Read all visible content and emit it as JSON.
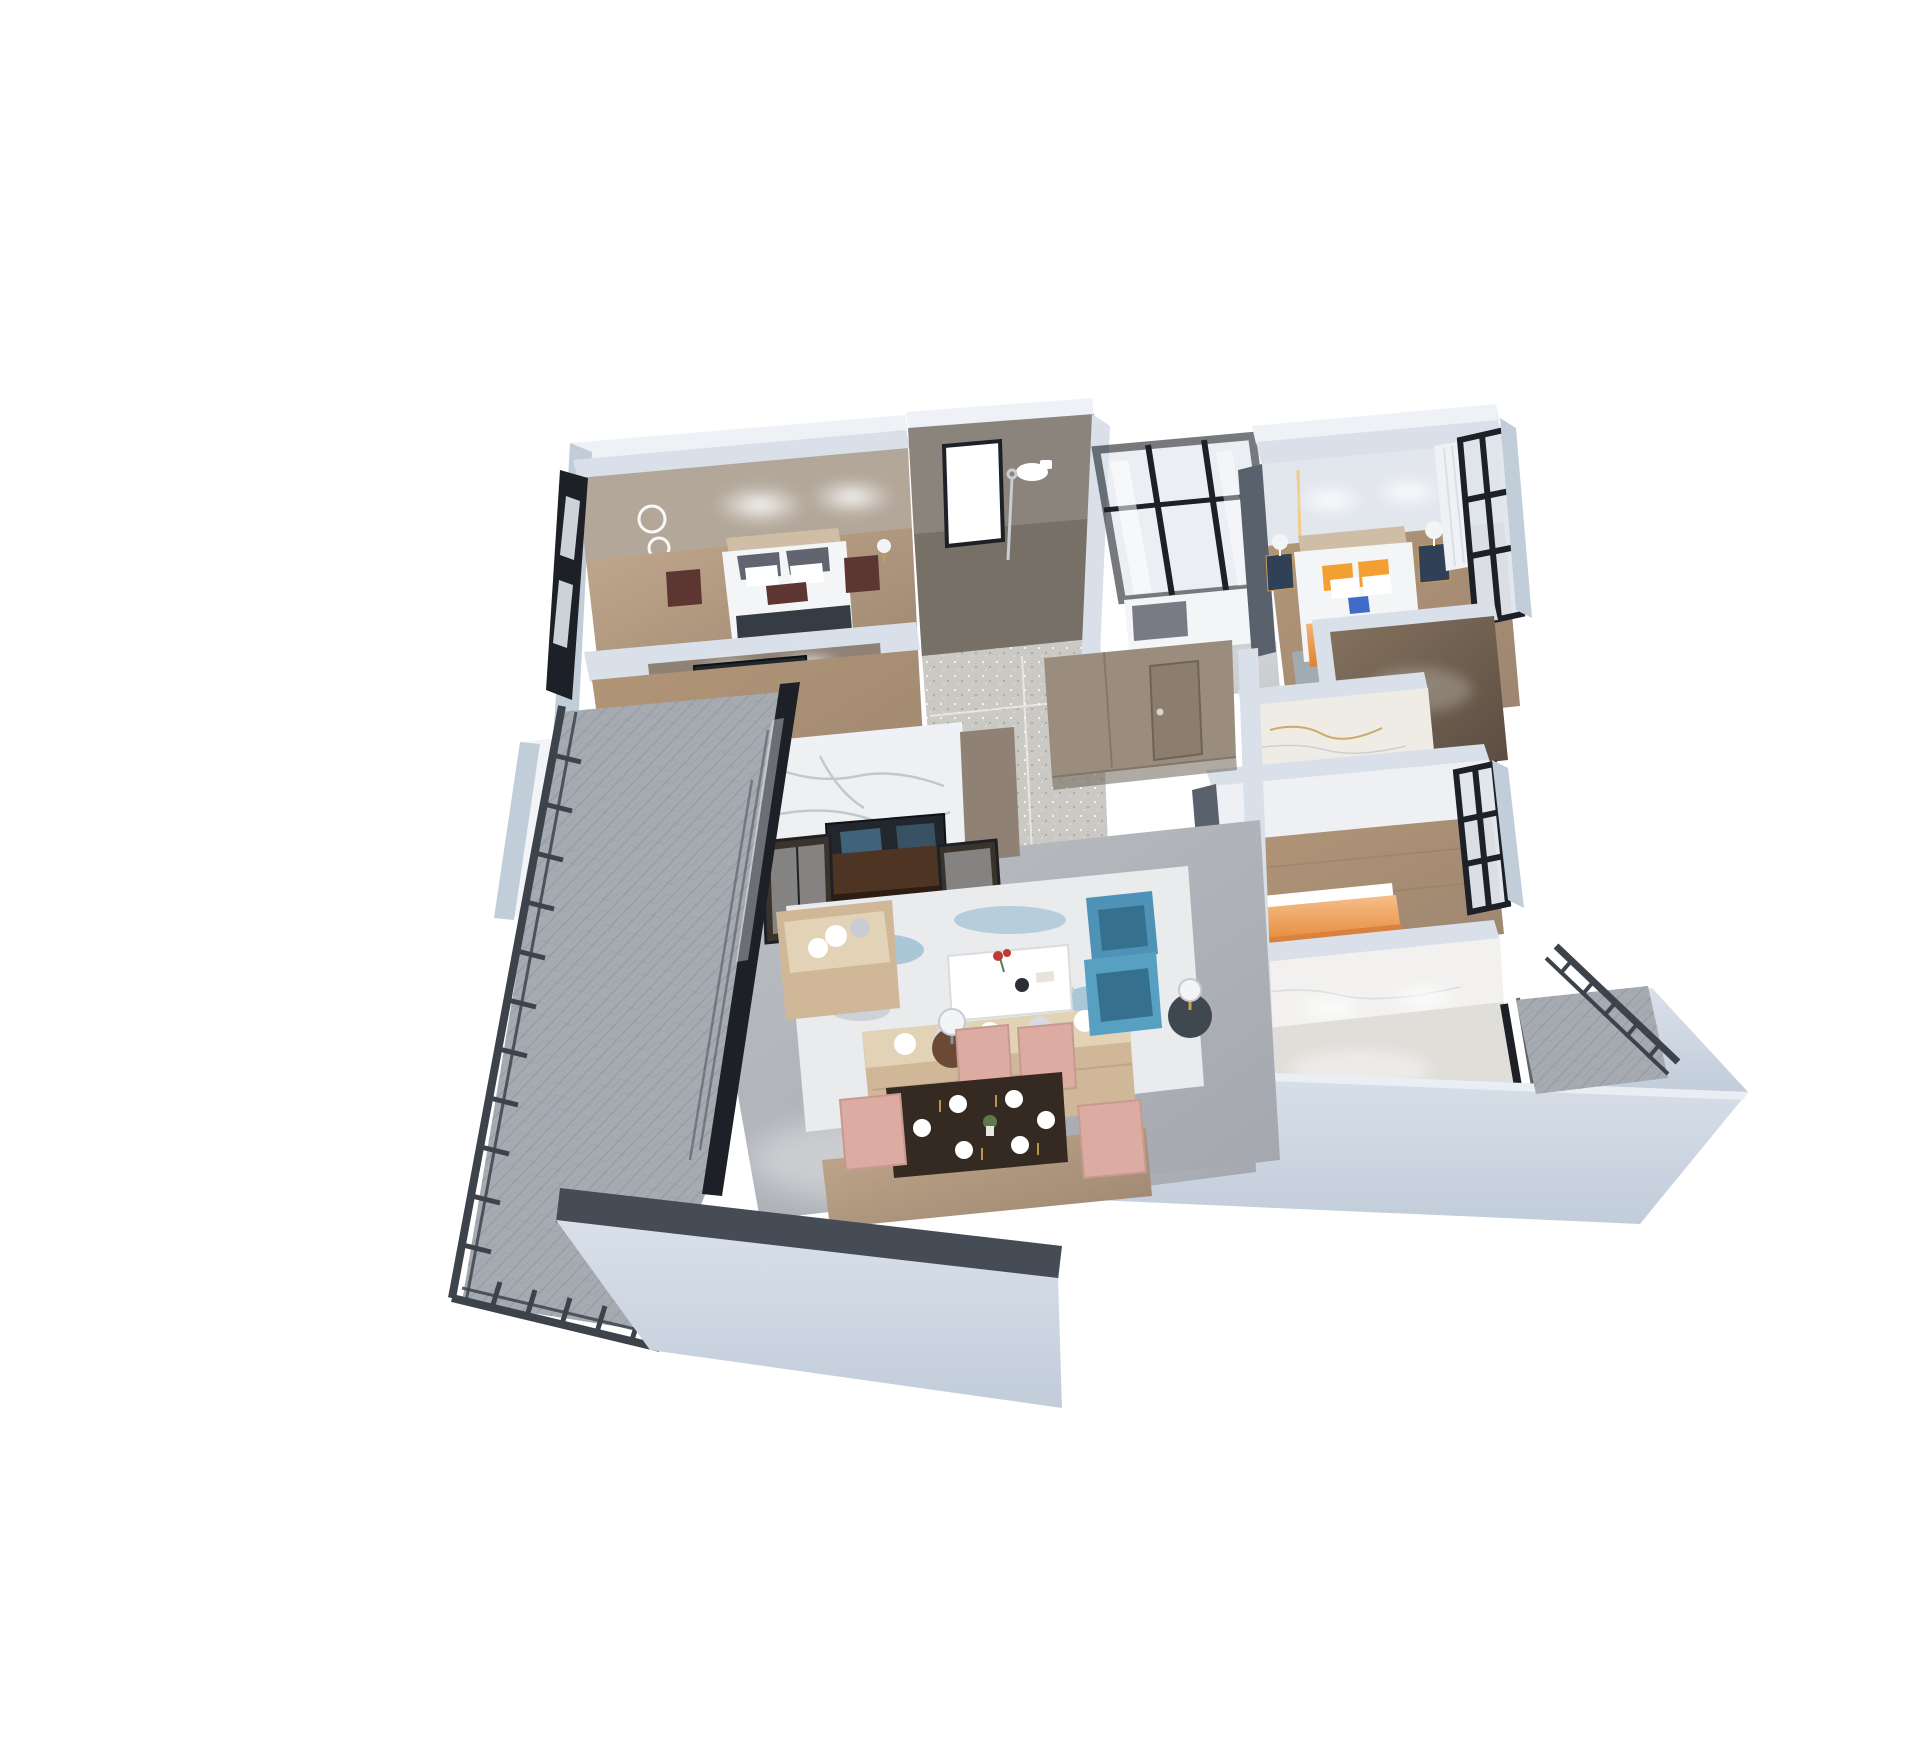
{
  "canvas": {
    "width": 1920,
    "height": 1754,
    "background": "#ffffff",
    "description": "Photorealistic 3D dollhouse-style isometric render of a furnished apartment floor plan on a white background"
  },
  "scene": {
    "rooms": [
      {
        "id": "bedroom-top-left",
        "label": "Bedroom 1",
        "furniture": [
          "double bed with dark gray pillows",
          "beige headboard",
          "two dark walnut nightstands",
          "ring pendant wall light",
          "left window wall",
          "ceiling spotlights"
        ]
      },
      {
        "id": "tv-room",
        "label": "Bedroom 1 TV wall / second room",
        "furniture": [
          "wall-mounted TV",
          "wood floor",
          "left window"
        ]
      },
      {
        "id": "bathroom-main",
        "label": "Main bathroom",
        "furniture": [
          "white glass shower door",
          "toilet",
          "shower column",
          "taupe stone tile walls",
          "speckled tile floor"
        ]
      },
      {
        "id": "glass-study",
        "label": "Glass-walled small bedroom",
        "furniture": [
          "black framed glass partition",
          "bed with patterned pillow",
          "blue stool"
        ]
      },
      {
        "id": "master-bedroom",
        "label": "Master bedroom",
        "furniture": [
          "bed with orange pillows and orange runner",
          "navy nightstands with white drum lamps",
          "charcoal wardrobe",
          "black framed window wall",
          "white curtain",
          "blue rug",
          "warm LED wall strips"
        ]
      },
      {
        "id": "ensuite",
        "label": "Ensuite / walk-in",
        "furniture": [
          "dark brown glossy marble floor"
        ]
      },
      {
        "id": "bathroom-gold",
        "label": "Marble bathroom",
        "furniture": [
          "white marble walls with gold veining"
        ]
      },
      {
        "id": "bedroom-right",
        "label": "Bedroom 2",
        "furniture": [
          "orange upholstered bed",
          "charcoal wardrobe strip",
          "black framed window",
          "wood plank floor"
        ]
      },
      {
        "id": "kitchen",
        "label": "Kitchen / utility room",
        "furniture": [
          "white marble walls",
          "two ceiling spotlights",
          "dark base trim",
          "black framed glass door"
        ]
      },
      {
        "id": "hallway",
        "label": "Entry hall",
        "furniture": [
          "taupe built-in cabinets",
          "entry door with handle",
          "gray marble floor"
        ]
      },
      {
        "id": "living-room",
        "label": "Living room",
        "furniture": [
          "white marble media wall",
          "walnut TV console with abstract-art TV",
          "two dark glass display cabinets",
          "beige sectional sofa with white pillows",
          "two blue wingback armchairs",
          "white marble coffee table with red flowers",
          "blue-and-white abstract rug",
          "round side tables with lamps"
        ]
      },
      {
        "id": "dining-area",
        "label": "Dining area",
        "furniture": [
          "dark wood dining table",
          "six white place settings with gold cutlery",
          "flower centerpiece",
          "four blush pink chairs",
          "wood floor strip"
        ]
      },
      {
        "id": "balcony-left",
        "label": "Left balcony",
        "furniture": [
          "gray herringbone carpet tile",
          "dark metal railing",
          "black framed glass sliding wall",
          "white exterior wall"
        ]
      },
      {
        "id": "balcony-right",
        "label": "Right balcony",
        "furniture": [
          "gray carpet tile",
          "dark metal railing"
        ]
      },
      {
        "id": "front-walls",
        "label": "Cut-away facade walls",
        "furniture": [
          "pale blue-gray wall slabs",
          "charcoal wall caps"
        ]
      }
    ]
  },
  "colors": {
    "bg": "#ffffff",
    "white": "#ffffff",
    "wallCap": "#eef2f7",
    "wallLight": "#d9e0ea",
    "wallMid": "#c2cdda",
    "wallShadow": "#a9b6c6",
    "charcoal": "#363c44",
    "railDark": "#3c434b",
    "glassFrame": "#1d2127",
    "glassPane": "#dfe5ec",
    "tileTaupe": "#8b847c",
    "tileTaupeDark": "#767066",
    "sparkleFloor": "#cbc9c4",
    "bedroomWall": "#b3a79a",
    "woodFloorA": "#c2a98d",
    "woodFloorB": "#9c8570",
    "woodFloorC": "#b29677",
    "marbleWhite": "#eef0f2",
    "marbleVein": "#b9bec6",
    "marbleGoldBase": "#efece6",
    "goldVein": "#c8a050",
    "floorMarble": "#bcbfc4",
    "floorMarbleDark": "#a3a7ad",
    "darkMarble": "#594b40",
    "darkMarbleLight": "#85735f",
    "kitchenWall": "#f2f1ef",
    "kitchenFloor": "#e0ded9",
    "bedWhite": "#f4f5f7",
    "pillowDark": "#62656f",
    "headboardBeige": "#cfbda6",
    "nightstandMaroon": "#5d3531",
    "navyStand": "#2f4057",
    "orange": "#f2a031",
    "orangeDeep": "#e2812c",
    "orangeBedLight": "#f6bf8a",
    "orangeBedDark": "#d9813f",
    "blueAccent": "#3f6bc9",
    "sofaBeige": "#cfb797",
    "sofaLight": "#e3d3b6",
    "blueChair": "#4e93b7",
    "blueChairLight": "#58a0c2",
    "blueChairDark": "#35718f",
    "rugBase": "#e9ebed",
    "rugBlue": "#7fb0c8",
    "blushChair": "#dcaba1",
    "tableDark": "#352a21",
    "consoleWood": "#4e3523",
    "tvDark": "#22262d",
    "tvBlue": "#4f7d9a",
    "carpetGray": "#a6abb2",
    "carpetLine": "#8f959d",
    "curtainWhite": "#eff1f4",
    "ledWarm": "#f5c97e",
    "lampWhite": "#f3f4f6",
    "blueStool": "#5a7fb0",
    "blueRug": "#9fb4c7",
    "taupePanel": "#8f8274",
    "taupeCabinet": "#9a8d7d",
    "doorTaupe": "#8b7e6e",
    "masterWall": "#e2e6ed",
    "wardrobeGray": "#59616d",
    "redFlower": "#c03a33",
    "greenPlant": "#5c7a4a"
  }
}
